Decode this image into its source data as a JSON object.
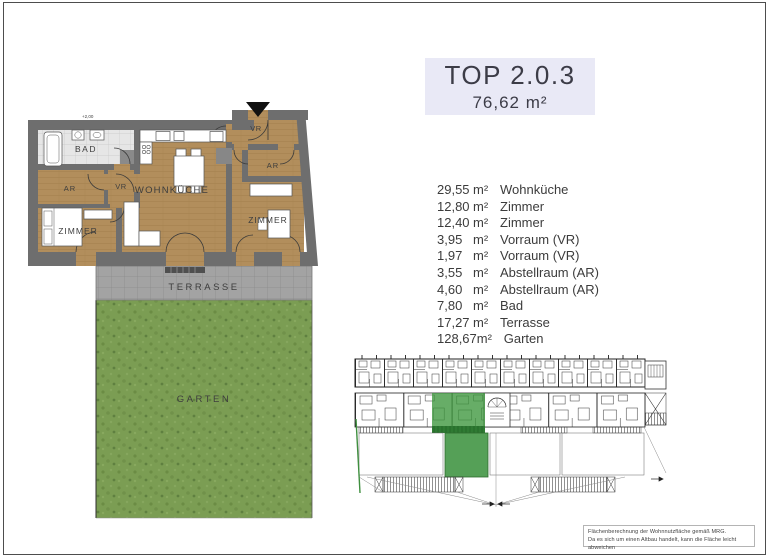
{
  "header": {
    "unit_title": "TOP 2.0.3",
    "total_area": "76,62 m²"
  },
  "area_list": [
    {
      "value": "29,55",
      "unit": "m²",
      "name": "Wohnküche"
    },
    {
      "value": "12,80",
      "unit": "m²",
      "name": "Zimmer"
    },
    {
      "value": "12,40",
      "unit": "m²",
      "name": "Zimmer"
    },
    {
      "value": "3,95",
      "unit": "m²",
      "name": "Vorraum (VR)"
    },
    {
      "value": "1,97",
      "unit": "m²",
      "name": "Vorraum (VR)"
    },
    {
      "value": "3,55",
      "unit": "m²",
      "name": "Abstellraum (AR)"
    },
    {
      "value": "4,60",
      "unit": "m²",
      "name": "Abstellraum (AR)"
    },
    {
      "value": "7,80",
      "unit": "m²",
      "name": "Bad"
    },
    {
      "value": "17,27",
      "unit": "m²",
      "name": "Terrasse"
    },
    {
      "value": "128,67",
      "unit": "m²",
      "name": "Garten"
    }
  ],
  "floorplan": {
    "labels": {
      "bad": "BAD",
      "ar_left": "AR",
      "vr_left": "VR",
      "zimmer_left": "ZIMMER",
      "wohnkueche": "WOHNKÜCHE",
      "vr_right": "VR",
      "ar_right": "AR",
      "zimmer_right": "ZIMMER",
      "terrasse": "TERRASSE",
      "garten": "GARTEN"
    },
    "level_label": "+2,00"
  },
  "footnote": {
    "line1": "Flächenberechnung der Wohnnutzfläche gemäß MRG.",
    "line2": "Da es sich um einen Altbau handelt, kann die Fläche leicht abweichen"
  },
  "colors": {
    "title_box_bg": "#e9e9f6",
    "wall_gray": "#6e6e6e",
    "wood_floor": "#b28e5c",
    "tile_floor": "#e6e6e6",
    "terrace_gray": "#a3a3a3",
    "garden_green": "#7b9d53",
    "siteplan_unit_green": "#3c963c",
    "siteplan_garden_green": "#55a057"
  }
}
